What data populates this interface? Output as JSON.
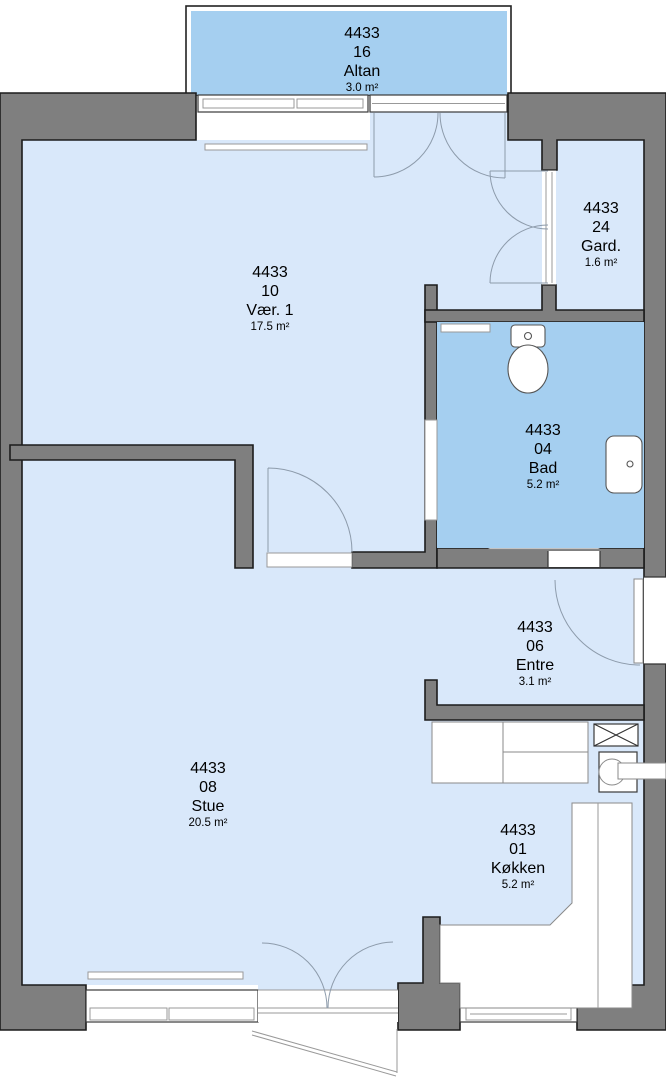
{
  "colors": {
    "wall": "#7f7f7f",
    "outline": "#1c1c1c",
    "room_light": "#d9e8fa",
    "room_highlight": "#a5cff0",
    "door_arc": "#8d9bab"
  },
  "rooms": [
    {
      "id": "altan",
      "apt": "4433",
      "number": "16",
      "name": "Altan",
      "area": "3.0 m²"
    },
    {
      "id": "vaer1",
      "apt": "4433",
      "number": "10",
      "name": "Vær. 1",
      "area": "17.5 m²"
    },
    {
      "id": "gard",
      "apt": "4433",
      "number": "24",
      "name": "Gard.",
      "area": "1.6 m²"
    },
    {
      "id": "bad",
      "apt": "4433",
      "number": "04",
      "name": "Bad",
      "area": "5.2 m²"
    },
    {
      "id": "entre",
      "apt": "4433",
      "number": "06",
      "name": "Entre",
      "area": "3.1 m²"
    },
    {
      "id": "stue",
      "apt": "4433",
      "number": "08",
      "name": "Stue",
      "area": "20.5 m²"
    },
    {
      "id": "koekken",
      "apt": "4433",
      "number": "01",
      "name": "Køkken",
      "area": "5.2 m²"
    }
  ],
  "fixtures": [
    "toilet",
    "washbasin",
    "ventilation-shaft",
    "utility-connection",
    "kitchen-counter",
    "cabinets",
    "radiator"
  ]
}
